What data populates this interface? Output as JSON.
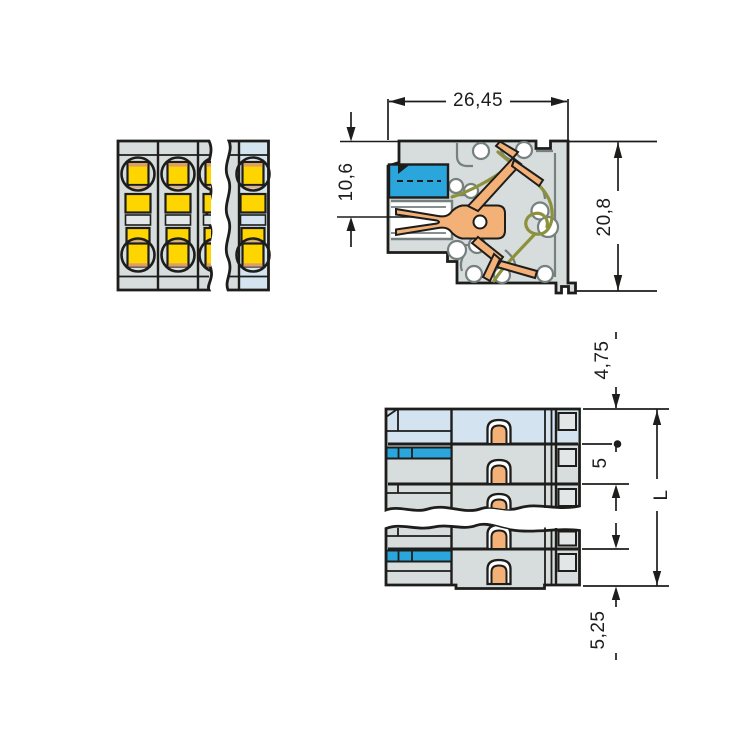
{
  "drawing_title": "connector-technical-drawing",
  "dimensions": {
    "overall_width": "26,45",
    "entry_height": "10,6",
    "overall_height": "20,8",
    "top_offset": "4,75",
    "pole_pitch": "5",
    "overall_length": "L",
    "bottom_offset": "5,25"
  },
  "colors": {
    "outline": "#1d1d1b",
    "housing_gray": "#d7dcdc",
    "cavity_gray": "#75807f",
    "light_band": "#e3e7e7",
    "light_blue": "#d3e3ef",
    "blue": "#2aa6dd",
    "yellow": "#ffd500",
    "orange_contact": "#f3b077",
    "orange_strip": "#dd9f66",
    "tan_strip": "#d8b28c",
    "olive_spring": "#8d913c",
    "white": "#ffffff"
  }
}
